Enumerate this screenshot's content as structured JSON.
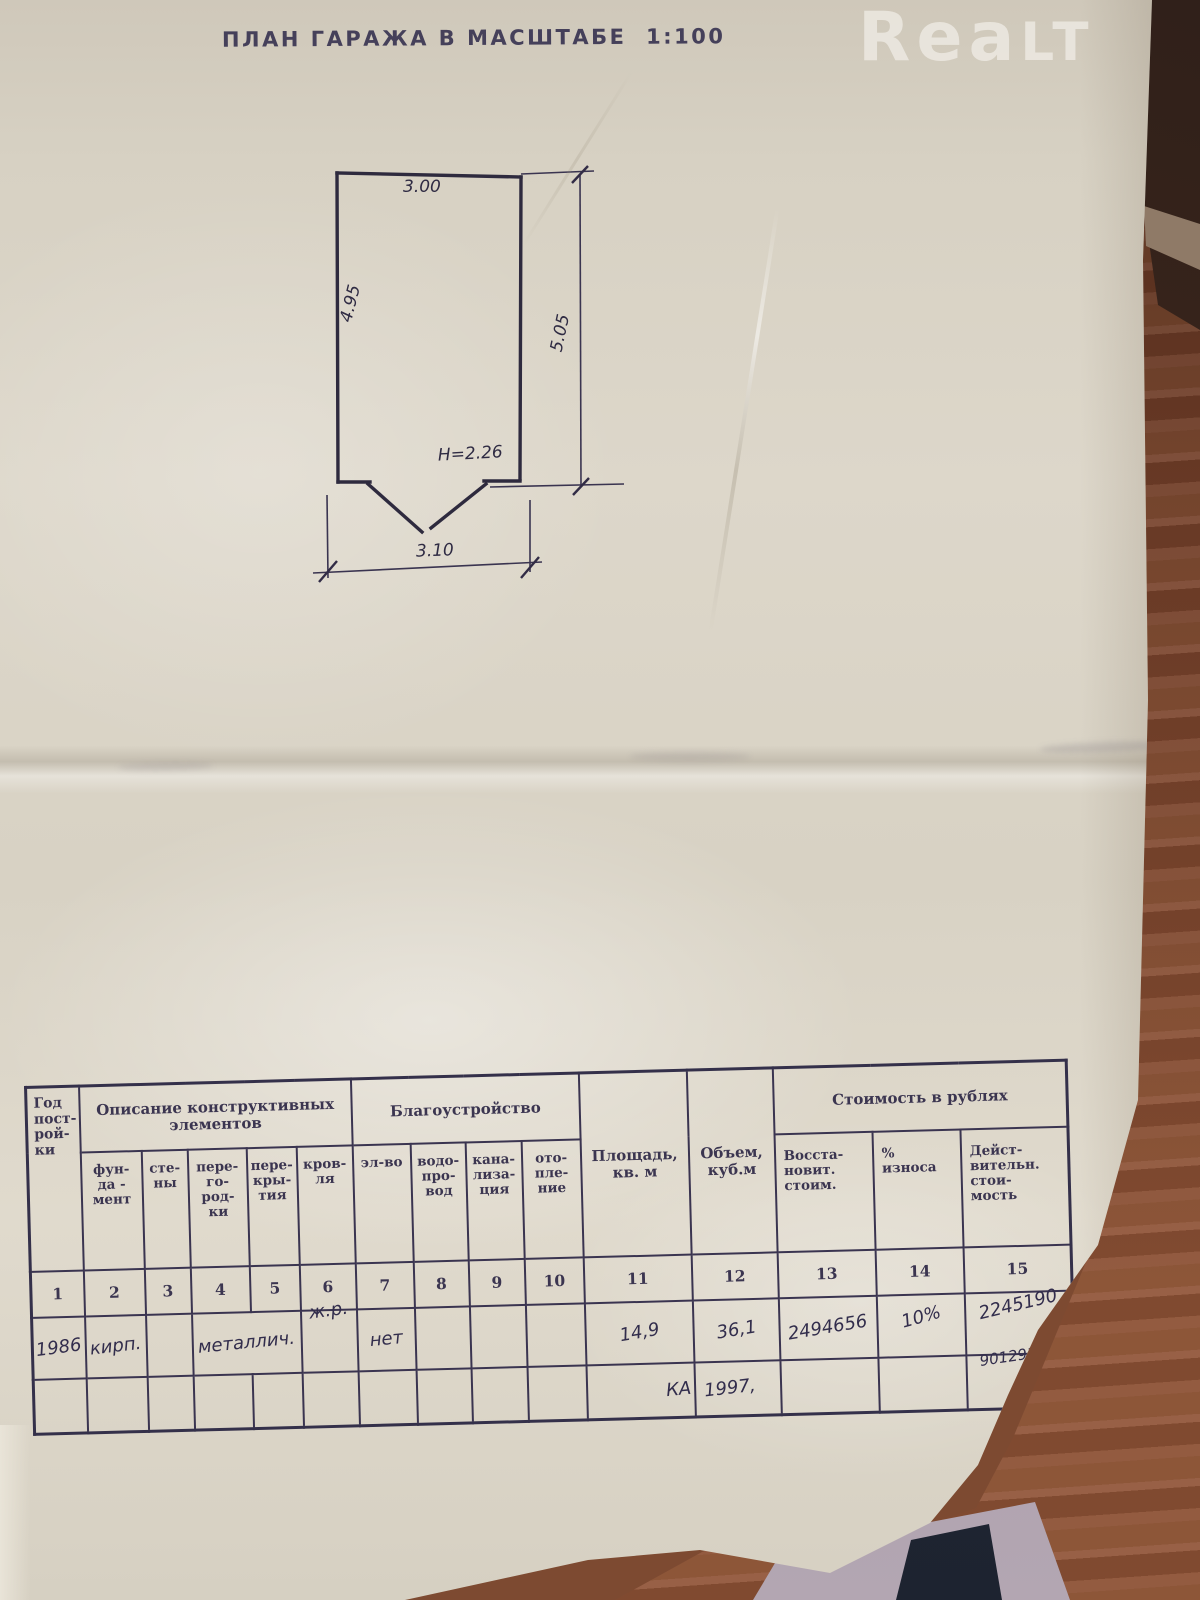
{
  "watermark": {
    "main": "Rea",
    "caps": "LT"
  },
  "title": "ПЛАН ГАРАЖА В МАСШТАБЕ  1:100",
  "plan": {
    "dim_top": "3.00",
    "dim_left": "4.95",
    "dim_right": "5.05",
    "dim_height": "H=2.26",
    "dim_bottom": "3.10"
  },
  "table": {
    "header": {
      "year": "Год\nпост-\nрой-\nки",
      "construction_group": "Описание конструктивных\nэлементов",
      "construction_cols": [
        "фун-\nда -\nмент",
        "сте-\nны",
        "пере-\nго-\nрод-\nки",
        "пере-\nкры-\nтия",
        "кров-\nля"
      ],
      "amenities_group": "Благоустройство",
      "amenities_cols": [
        "эл-во",
        "водо-\nпро-\nвод",
        "кана-\nлиза-\nция",
        "ото-\nпле-\nние"
      ],
      "area": "Площадь,\nкв. м",
      "volume": "Объем,\nкуб.м",
      "cost_group": "Стоимость в рублях",
      "cost_cols": [
        "Восста-\nновит.\nстоим.",
        "%\nизноса",
        "Дейст-\nвительн.\nстои-\nмость"
      ]
    },
    "column_numbers": [
      "1",
      "2",
      "3",
      "4",
      "5",
      "6",
      "7",
      "8",
      "9",
      "10",
      "11",
      "12",
      "13",
      "14",
      "15"
    ],
    "rows": [
      [
        "1986",
        "кирп.",
        "",
        "металлич.",
        "ж.р.",
        "нет",
        "",
        "",
        "",
        "14,9",
        "36,1",
        "2494656",
        "10%",
        "2245190"
      ],
      [
        "",
        "",
        "",
        "",
        "",
        "",
        "",
        "",
        "",
        "",
        "КА",
        "1997,",
        "",
        "",
        "9012914р."
      ]
    ]
  },
  "colors": {
    "paper": "#d9d3c6",
    "ink": "#37314b",
    "handwriting": "#322d4c",
    "wood_floor": "#7d4a31",
    "watermark": "#ffffff"
  }
}
